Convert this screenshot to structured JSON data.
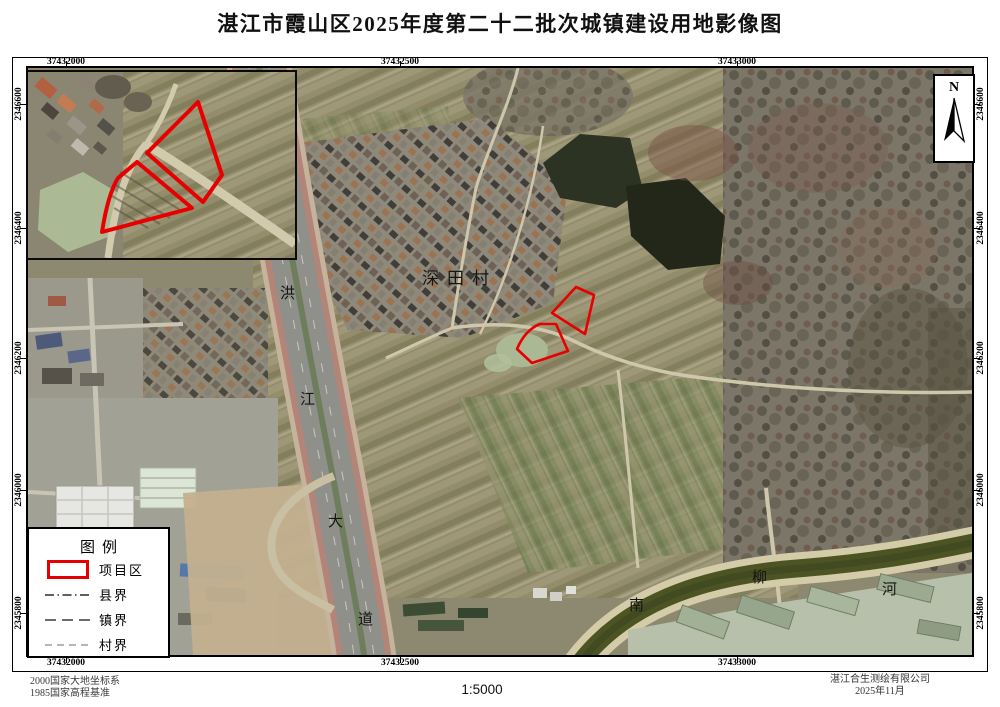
{
  "title": "湛江市霞山区2025年度第二十二批次城镇建设用地影像图",
  "coords": {
    "top": [
      "37432000",
      "37432500",
      "37433000"
    ],
    "bottom": [
      "37432000",
      "37432500",
      "37433000"
    ],
    "left": [
      "2346600",
      "2346400",
      "2346200",
      "2346000",
      "2345800"
    ],
    "right": [
      "2346600",
      "2346400",
      "2346200",
      "2346000",
      "2345800"
    ]
  },
  "map_labels": {
    "village": "深田村",
    "road": [
      "洪",
      "江",
      "大",
      "道"
    ],
    "river": [
      "南",
      "柳",
      "河"
    ]
  },
  "north_label": "N",
  "legend": {
    "title": "图例",
    "items": [
      {
        "label": "项目区",
        "symbol": "project-area"
      },
      {
        "label": "县界",
        "symbol": "county-boundary"
      },
      {
        "label": "镇界",
        "symbol": "town-boundary"
      },
      {
        "label": "村界",
        "symbol": "village-boundary"
      }
    ]
  },
  "footer": {
    "datum_line1": "2000国家大地坐标系",
    "datum_line2": "1985国家高程基准",
    "scale": "1:5000",
    "company": "湛江合生测绘有限公司",
    "date": "2025年11月"
  },
  "colors": {
    "project_outline": "#e80000"
  }
}
